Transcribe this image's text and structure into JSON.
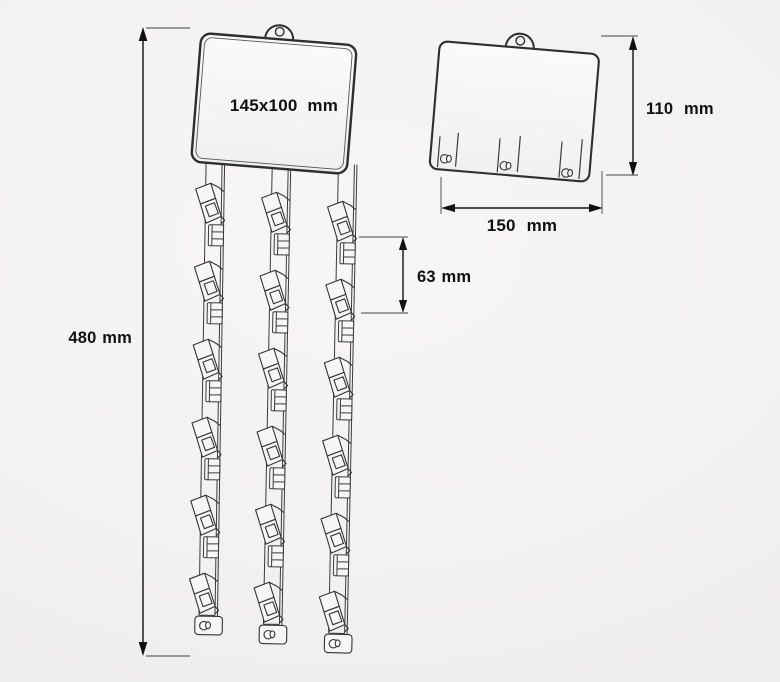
{
  "diagram": {
    "kind": "clip-strip-technical-drawing",
    "front_view": {
      "strips": 3,
      "clips_per_strip": 6
    },
    "back_view": {
      "bottom_slots": 3
    }
  },
  "labels": {
    "sign_size": "145x100 mm",
    "total_height": "480 mm",
    "clip_spacing": "63 mm",
    "back_plate_height": "110 mm",
    "back_plate_width": "150 mm"
  },
  "colors": {
    "background": "#f2f1f1",
    "line": "#2e2e2e",
    "dimension": "#111111",
    "text": "#111111"
  }
}
